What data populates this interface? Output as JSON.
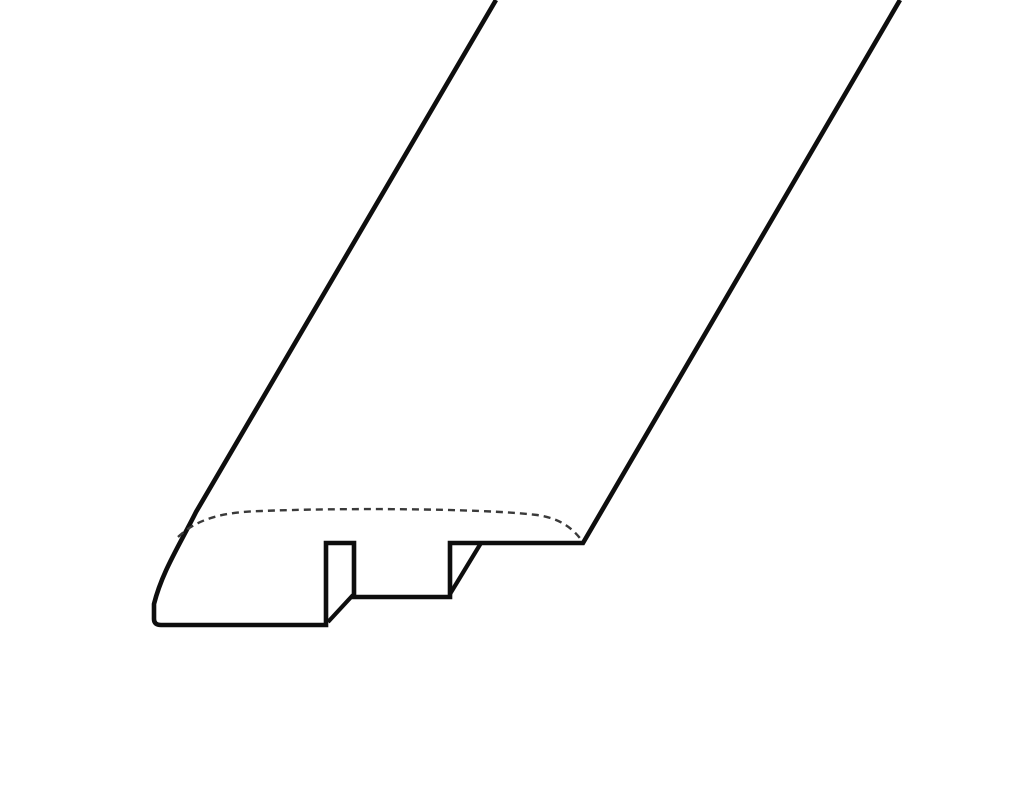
{
  "page": {
    "background": "#ffffff",
    "description": "Isometric line drawing of a flooring reducer molding profile with slotted underside"
  },
  "diagram": {
    "viewBox": "0 0 1024 787",
    "colors": {
      "outline": "#0e0e0e",
      "hidden_edge": "#3a3a3a",
      "background": "#ffffff"
    },
    "strokes": {
      "outline_width": 4.6,
      "inner_edge_width": 4.2,
      "hidden_width": 2.4,
      "hidden_dash": "7 5"
    },
    "paths": [
      {
        "name": "molding-outline",
        "role": "solid front cross-section outline with long extrusion edges",
        "d": "M 496 0 L 196 512 C 179 546 162 572 154 604 L 154 619 Q 154 625 161 625 L 326 625 L 326 543 L 354 543 L 354 597 L 450 597 L 450 543 L 583 543 L 900 0",
        "stroke_key": "outline",
        "width_key": "outline_width",
        "dashed": false
      },
      {
        "name": "groove-left-receding-edge",
        "role": "inner depth edge at left of bottom slot",
        "d": "M 328 622 L 353 595",
        "stroke_key": "outline",
        "width_key": "inner_edge_width",
        "dashed": false
      },
      {
        "name": "groove-right-receding-edge",
        "role": "inner depth edge at right of bottom slot",
        "d": "M 450 594 L 481 543",
        "stroke_key": "outline",
        "width_key": "inner_edge_width",
        "dashed": false
      },
      {
        "name": "rounded-top-hidden-edge",
        "role": "dashed hidden line marking rounded-over top surface at cut end",
        "d": "M 178 537 C 198 518 224 512 262 511 C 332 508 480 508 537 515 C 559 518 573 528 582 541",
        "stroke_key": "hidden_edge",
        "width_key": "hidden_width",
        "dashed": true
      }
    ]
  }
}
